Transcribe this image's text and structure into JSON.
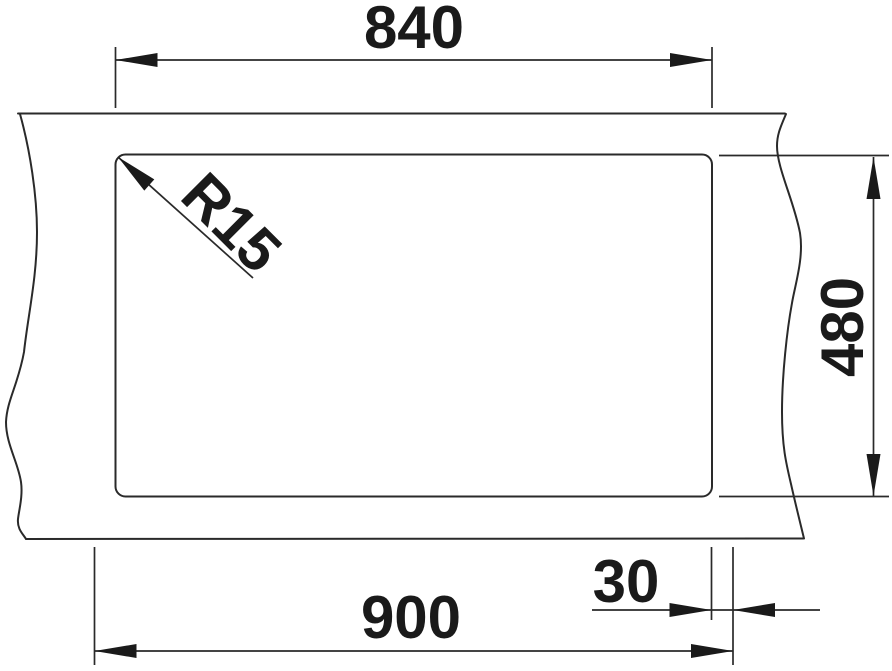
{
  "page": {
    "background": "#ffffff"
  },
  "drawing": {
    "ink_color": "#2a2a2a",
    "text_color": "#1a1a1a",
    "labels": {
      "cutout_width": "840",
      "depth": "480",
      "overall_width": "900",
      "rim_offset": "30",
      "corner_radius": "R15"
    }
  }
}
